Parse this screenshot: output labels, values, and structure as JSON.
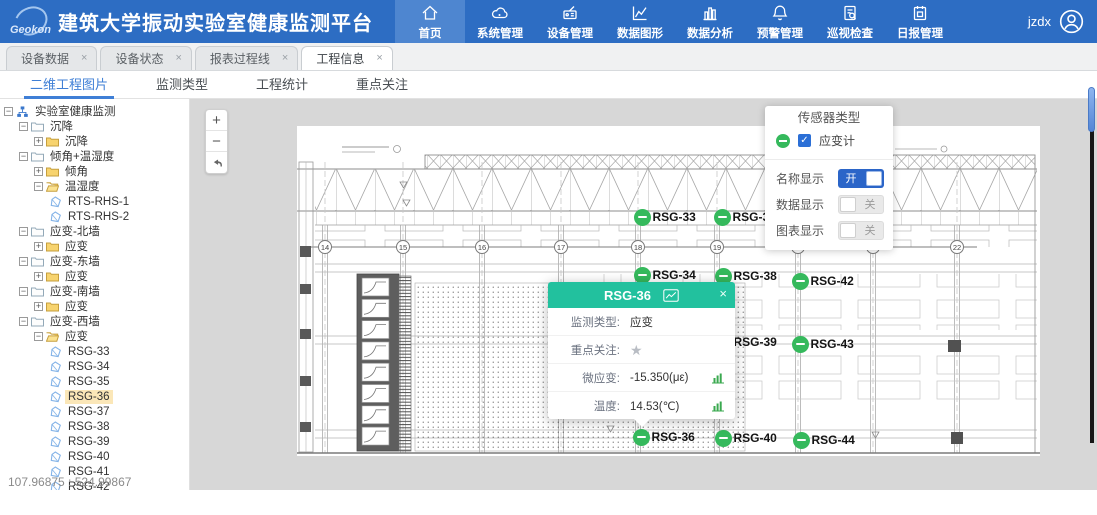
{
  "header": {
    "logo_text": "Geokon",
    "title": "建筑大学振动实验室健康监测平台",
    "user_name": "jzdx",
    "nav": [
      {
        "label": "首页",
        "icon": "home-icon",
        "active": true
      },
      {
        "label": "系统管理",
        "icon": "system-icon",
        "active": false
      },
      {
        "label": "设备管理",
        "icon": "device-icon",
        "active": false
      },
      {
        "label": "数据图形",
        "icon": "data-graph-icon",
        "active": false
      },
      {
        "label": "数据分析",
        "icon": "data-analysis-icon",
        "active": false
      },
      {
        "label": "预警管理",
        "icon": "alert-bell-icon",
        "active": false
      },
      {
        "label": "巡视检查",
        "icon": "inspection-icon",
        "active": false
      },
      {
        "label": "日报管理",
        "icon": "daily-report-icon",
        "active": false
      }
    ]
  },
  "tabs_close_glyph": "×",
  "tabs": [
    {
      "label": "设备数据",
      "active": false
    },
    {
      "label": "设备状态",
      "active": false
    },
    {
      "label": "报表过程线",
      "active": false
    },
    {
      "label": "工程信息",
      "active": true
    }
  ],
  "subtabs": [
    {
      "label": "二维工程图片",
      "active": true
    },
    {
      "label": "监测类型",
      "active": false
    },
    {
      "label": "工程统计",
      "active": false
    },
    {
      "label": "重点关注",
      "active": false
    }
  ],
  "tree": {
    "items": [
      {
        "label": "实验室健康监测",
        "level": 0,
        "expander": "minus",
        "icon": "org-icon",
        "selected": false
      },
      {
        "label": "沉降",
        "level": 1,
        "expander": "minus",
        "icon": "folder-outline-icon",
        "selected": false
      },
      {
        "label": "沉降",
        "level": 2,
        "expander": "plus",
        "icon": "folder-icon",
        "selected": false
      },
      {
        "label": "倾角+温湿度",
        "level": 1,
        "expander": "minus",
        "icon": "folder-outline-icon",
        "selected": false
      },
      {
        "label": "倾角",
        "level": 2,
        "expander": "plus",
        "icon": "folder-icon",
        "selected": false
      },
      {
        "label": "温湿度",
        "level": 2,
        "expander": "minus",
        "icon": "folder-open-icon",
        "selected": false
      },
      {
        "label": "RTS-RHS-1",
        "level": 3,
        "expander": null,
        "icon": "sensor-icon",
        "selected": false
      },
      {
        "label": "RTS-RHS-2",
        "level": 3,
        "expander": null,
        "icon": "sensor-icon",
        "selected": false
      },
      {
        "label": "应变-北墙",
        "level": 1,
        "expander": "minus",
        "icon": "folder-outline-icon",
        "selected": false
      },
      {
        "label": "应变",
        "level": 2,
        "expander": "plus",
        "icon": "folder-icon",
        "selected": false
      },
      {
        "label": "应变-东墙",
        "level": 1,
        "expander": "minus",
        "icon": "folder-outline-icon",
        "selected": false
      },
      {
        "label": "应变",
        "level": 2,
        "expander": "plus",
        "icon": "folder-icon",
        "selected": false
      },
      {
        "label": "应变-南墙",
        "level": 1,
        "expander": "minus",
        "icon": "folder-outline-icon",
        "selected": false
      },
      {
        "label": "应变",
        "level": 2,
        "expander": "plus",
        "icon": "folder-icon",
        "selected": false
      },
      {
        "label": "应变-西墙",
        "level": 1,
        "expander": "minus",
        "icon": "folder-outline-icon",
        "selected": false
      },
      {
        "label": "应变",
        "level": 2,
        "expander": "minus",
        "icon": "folder-open-icon",
        "selected": false
      },
      {
        "label": "RSG-33",
        "level": 3,
        "expander": null,
        "icon": "sensor-icon",
        "selected": false
      },
      {
        "label": "RSG-34",
        "level": 3,
        "expander": null,
        "icon": "sensor-icon",
        "selected": false
      },
      {
        "label": "RSG-35",
        "level": 3,
        "expander": null,
        "icon": "sensor-icon",
        "selected": false
      },
      {
        "label": "RSG-36",
        "level": 3,
        "expander": null,
        "icon": "sensor-icon",
        "selected": true
      },
      {
        "label": "RSG-37",
        "level": 3,
        "expander": null,
        "icon": "sensor-icon",
        "selected": false
      },
      {
        "label": "RSG-38",
        "level": 3,
        "expander": null,
        "icon": "sensor-icon",
        "selected": false
      },
      {
        "label": "RSG-39",
        "level": 3,
        "expander": null,
        "icon": "sensor-icon",
        "selected": false
      },
      {
        "label": "RSG-40",
        "level": 3,
        "expander": null,
        "icon": "sensor-icon",
        "selected": false
      },
      {
        "label": "RSG-41",
        "level": 3,
        "expander": null,
        "icon": "sensor-icon",
        "selected": false
      },
      {
        "label": "RSG-42",
        "level": 3,
        "expander": null,
        "icon": "sensor-icon",
        "selected": false
      }
    ]
  },
  "canvas": {
    "zoom_in_label": "+",
    "zoom_out_label": "−",
    "reset_icon": "undo-arrow-icon",
    "coordinates": "107.96875 : 524.99867",
    "grid_bubbles": [
      {
        "label": "14",
        "x": 28
      },
      {
        "label": "15",
        "x": 106
      },
      {
        "label": "16",
        "x": 185
      },
      {
        "label": "17",
        "x": 264
      },
      {
        "label": "18",
        "x": 341
      },
      {
        "label": "19",
        "x": 420
      },
      {
        "label": "20",
        "x": 501
      },
      {
        "label": "21",
        "x": 576
      },
      {
        "label": "22",
        "x": 660
      }
    ],
    "markers": [
      {
        "id": "RSG-33",
        "x": 345,
        "y": 91
      },
      {
        "id": "RSG-37",
        "x": 425,
        "y": 91
      },
      {
        "id": "RSG-41",
        "x": 503,
        "y": 92
      },
      {
        "id": "RSG-34",
        "x": 345,
        "y": 149
      },
      {
        "id": "RSG-38",
        "x": 426,
        "y": 150
      },
      {
        "id": "RSG-42",
        "x": 503,
        "y": 155
      },
      {
        "id": "RSG-39",
        "x": 426,
        "y": 216
      },
      {
        "id": "RSG-43",
        "x": 503,
        "y": 218
      },
      {
        "id": "RSG-36",
        "x": 344,
        "y": 311
      },
      {
        "id": "RSG-40",
        "x": 426,
        "y": 312
      },
      {
        "id": "RSG-44",
        "x": 504,
        "y": 314
      }
    ]
  },
  "popup": {
    "title": "RSG-36",
    "title_icon": "line-chart-icon",
    "close_glyph": "×",
    "rows": [
      {
        "label": "监测类型:",
        "kind": "text",
        "value": "应变"
      },
      {
        "label": "重点关注:",
        "kind": "star",
        "star_glyph": "★"
      },
      {
        "label": "微应变:",
        "kind": "value-chart",
        "value": "-15.350(με)"
      },
      {
        "label": "温度:",
        "kind": "value-chart",
        "value": "14.53(℃)"
      }
    ]
  },
  "sensor_panel": {
    "title": "传感器类型",
    "legend": {
      "marker_icon": "green-minus-circle-icon",
      "checkbox_checked": true,
      "check_glyph": "✓",
      "label": "应变计"
    },
    "toggles": [
      {
        "label": "名称显示",
        "state": "on",
        "text": "开"
      },
      {
        "label": "数据显示",
        "state": "off",
        "text": "关"
      },
      {
        "label": "图表显示",
        "state": "off",
        "text": "关"
      }
    ]
  },
  "colors": {
    "header_blue": "#2d6dc3",
    "header_active_blue": "#4e86d0",
    "marker_green": "#35b95c",
    "popup_header_teal": "#22c19e",
    "toggle_on_blue": "#2b65c8",
    "checkbox_blue": "#2b6fd6",
    "chart_icon_green": "#3aa94f",
    "tree_selected_bg": "#fbe7b8",
    "subtab_active_blue": "#3f7fd6"
  }
}
